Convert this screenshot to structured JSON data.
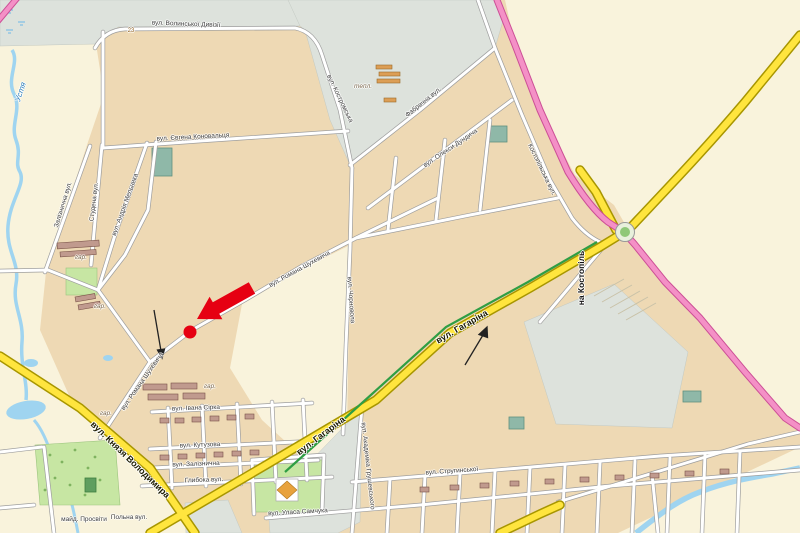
{
  "map": {
    "description": "city street map with highlighted location",
    "colors": {
      "background_cream": "#f9f3dc",
      "builtup_tan": "#eed9b4",
      "industrial_gray": "#dde2dc",
      "park_green": "#c7e6a3",
      "water_blue": "#9fd4f0",
      "major_road_yellow": "#ffe53e",
      "route_pink": "#f490c6",
      "transit_green_stripe": "#2f9e44",
      "marker_red": "#e60012"
    },
    "marker": {
      "dot_x": 190,
      "dot_y": 332,
      "arrow_tip_x": 197,
      "arrow_tip_y": 319
    },
    "labels": [
      {
        "t": "вул. Волинської Дивізії",
        "x": 186,
        "y": 25,
        "r": 2,
        "c": "st",
        "n": "street-label-volynskoi-dyvizii"
      },
      {
        "t": "вул. Євгена Коновальця",
        "x": 193,
        "y": 138,
        "r": -3,
        "c": "st",
        "n": "street-label-konovaltsia"
      },
      {
        "t": "Залізнична вул.",
        "x": 64,
        "y": 205,
        "r": -73,
        "c": "st",
        "n": "street-label-zaliznychna-nw"
      },
      {
        "t": "Студена вул.",
        "x": 95,
        "y": 202,
        "r": -83,
        "c": "st",
        "n": "street-label-studena"
      },
      {
        "t": "вул. Андрія Мельника",
        "x": 126,
        "y": 205,
        "r": -70,
        "c": "st",
        "n": "street-label-melnyka"
      },
      {
        "t": "вул. Романа Шухевича",
        "x": 300,
        "y": 270,
        "r": -29,
        "c": "st",
        "n": "street-label-shukhevycha-1"
      },
      {
        "t": "вул. Романа Шухевича",
        "x": 143,
        "y": 382,
        "r": -55,
        "c": "st",
        "n": "street-label-shukhevycha-2"
      },
      {
        "t": "вул. Чорновола",
        "x": 350,
        "y": 300,
        "r": 86,
        "c": "st",
        "n": "street-label-chornovola"
      },
      {
        "t": "вул. Олекси Дундича",
        "x": 451,
        "y": 149,
        "r": -34,
        "c": "st",
        "n": "street-label-dundycha"
      },
      {
        "t": "Фабрична вул.",
        "x": 424,
        "y": 103,
        "r": -39,
        "c": "st",
        "n": "street-label-fabrychna"
      },
      {
        "t": "вул. Костромська",
        "x": 339,
        "y": 99,
        "r": 64,
        "c": "st",
        "n": "street-label-kostromska"
      },
      {
        "t": "Костопільська вул.",
        "x": 541,
        "y": 170,
        "r": 64,
        "c": "st",
        "n": "street-label-kostopilska"
      },
      {
        "t": "вул. Гагаріна",
        "x": 462,
        "y": 327,
        "r": -30,
        "c": "mj",
        "n": "street-label-gagarina-1"
      },
      {
        "t": "вул. Гагаріна",
        "x": 321,
        "y": 436,
        "r": -37,
        "c": "mj",
        "n": "street-label-gagarina-2"
      },
      {
        "t": "вул. Князя Володимира",
        "x": 130,
        "y": 460,
        "r": 44,
        "c": "mj",
        "n": "street-label-kniazia-volodymyra"
      },
      {
        "t": "на Костопіль",
        "x": 581,
        "y": 278,
        "r": -90,
        "c": "dir",
        "n": "direction-label-kostopil"
      },
      {
        "t": "вул. Академіка Грушевського",
        "x": 367,
        "y": 466,
        "r": 84,
        "c": "st",
        "n": "street-label-hrushevskoho"
      },
      {
        "t": "вул. Стругинської",
        "x": 452,
        "y": 472,
        "r": -4,
        "c": "st",
        "n": "street-label-struhynskoi"
      },
      {
        "t": "вул. Івана Сірка",
        "x": 196,
        "y": 409,
        "r": -2,
        "c": "st",
        "n": "street-label-sirka"
      },
      {
        "t": "вул. Кутузова",
        "x": 200,
        "y": 446,
        "r": -2,
        "c": "st",
        "n": "street-label-kutuzova"
      },
      {
        "t": "вул. Залізнична",
        "x": 196,
        "y": 465,
        "r": -2,
        "c": "st",
        "n": "street-label-zaliznychna-s"
      },
      {
        "t": "Глибока вул.",
        "x": 204,
        "y": 481,
        "r": -2,
        "c": "st",
        "n": "street-label-hlyboka"
      },
      {
        "t": "вул. Уласа Самчука",
        "x": 298,
        "y": 513,
        "r": -3,
        "c": "st",
        "n": "street-label-samchuka"
      },
      {
        "t": "майд. Просвіти",
        "x": 84,
        "y": 520,
        "r": 0,
        "c": "st",
        "n": "square-label-prosvity"
      },
      {
        "t": "Польна вул.",
        "x": 129,
        "y": 518,
        "r": 0,
        "c": "st",
        "n": "street-label-polna"
      },
      {
        "t": "Устя",
        "x": 21,
        "y": 92,
        "r": -72,
        "c": "wt",
        "n": "river-label-ustia"
      },
      {
        "t": "тепл.",
        "x": 363,
        "y": 87,
        "r": 0,
        "c": "nat",
        "n": "area-label-greenhouses"
      },
      {
        "t": "гар.",
        "x": 81,
        "y": 258,
        "r": 0,
        "c": "nat",
        "n": "area-label-garages-1"
      },
      {
        "t": "гар.",
        "x": 100,
        "y": 307,
        "r": 0,
        "c": "nat",
        "n": "area-label-garages-2"
      },
      {
        "t": "гар.",
        "x": 210,
        "y": 387,
        "r": 0,
        "c": "nat",
        "n": "area-label-garages-3"
      },
      {
        "t": "гар.",
        "x": 106,
        "y": 414,
        "r": 0,
        "c": "nat",
        "n": "area-label-garages-4"
      },
      {
        "t": "23",
        "x": 131,
        "y": 31,
        "r": 0,
        "c": "hn",
        "n": "house-number"
      }
    ]
  }
}
